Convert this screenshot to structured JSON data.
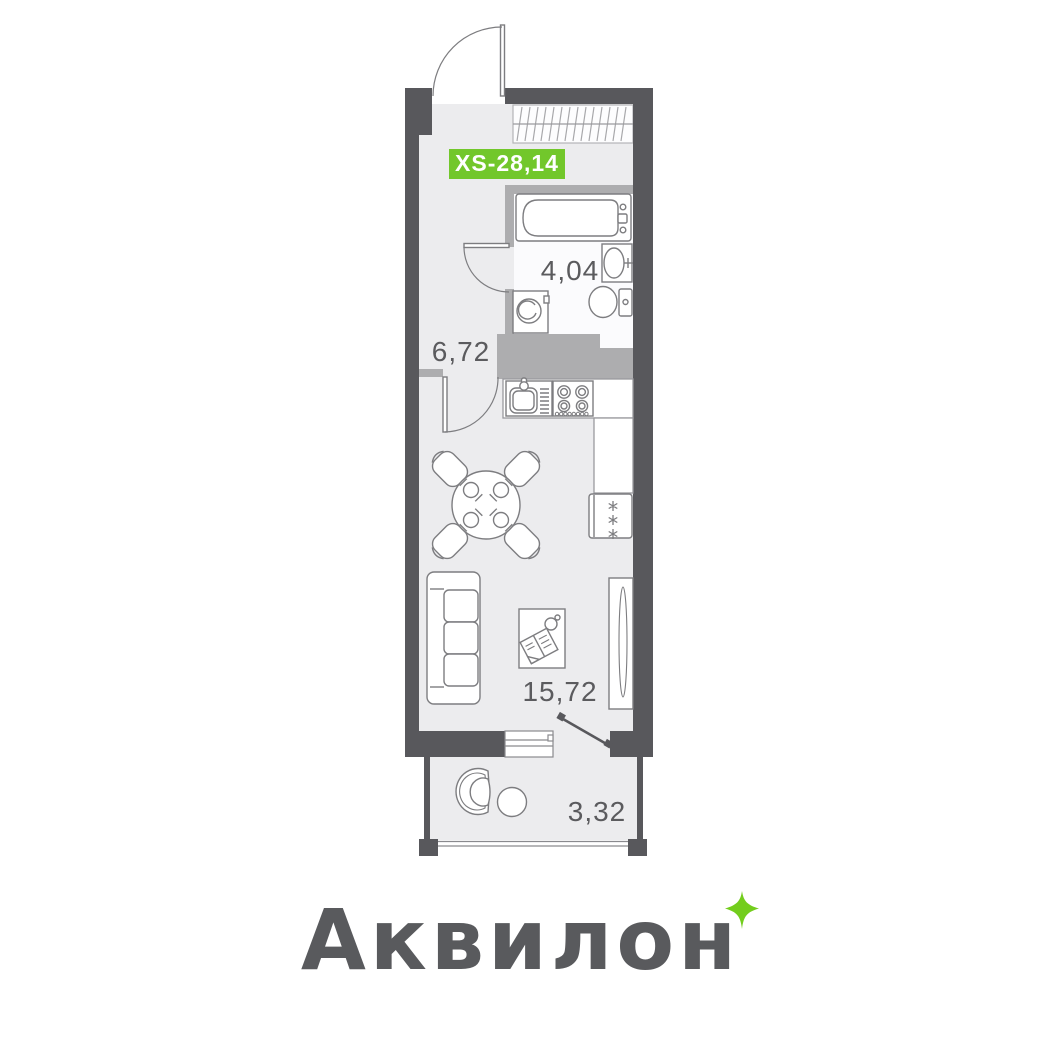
{
  "unit": {
    "badge": "XS-28,14"
  },
  "rooms": {
    "hallway": {
      "name": "hallway",
      "area": "6,72"
    },
    "bathroom": {
      "name": "bathroom",
      "area": "4,04"
    },
    "living": {
      "name": "living-kitchen",
      "area": "15,72"
    },
    "balcony": {
      "name": "balcony",
      "area": "3,32"
    }
  },
  "branding": {
    "logo": "Аквилон",
    "sparkle_icon": "four-point-star"
  },
  "furniture_icons": [
    "entrance-door-icon",
    "built-in-closet-icon",
    "bathtub-icon",
    "bathroom-sink-icon",
    "toilet-icon",
    "washing-machine-icon",
    "bathroom-door-icon",
    "kitchen-sink-icon",
    "stove-icon",
    "kitchen-counter-icon",
    "fridge-icon",
    "dining-table-icon",
    "chair-icon",
    "place-setting-icon",
    "interior-door-icon",
    "sofa-icon",
    "coffee-table-icon",
    "wardrobe-icon",
    "window-icon",
    "balcony-door-icon",
    "armchair-icon",
    "side-table-icon",
    "balcony-railing-icon"
  ],
  "colors": {
    "badge_green": "#72c72b",
    "sparkle_green": "#73cd1d",
    "wall_dark": "#58585c",
    "wall_light": "#adadaf",
    "floor": "#ececee",
    "bath_floor": "#fbfbfd",
    "label_text": "#5b5b5e",
    "logo_text": "#595a5d",
    "outline": "#7d7d80"
  }
}
